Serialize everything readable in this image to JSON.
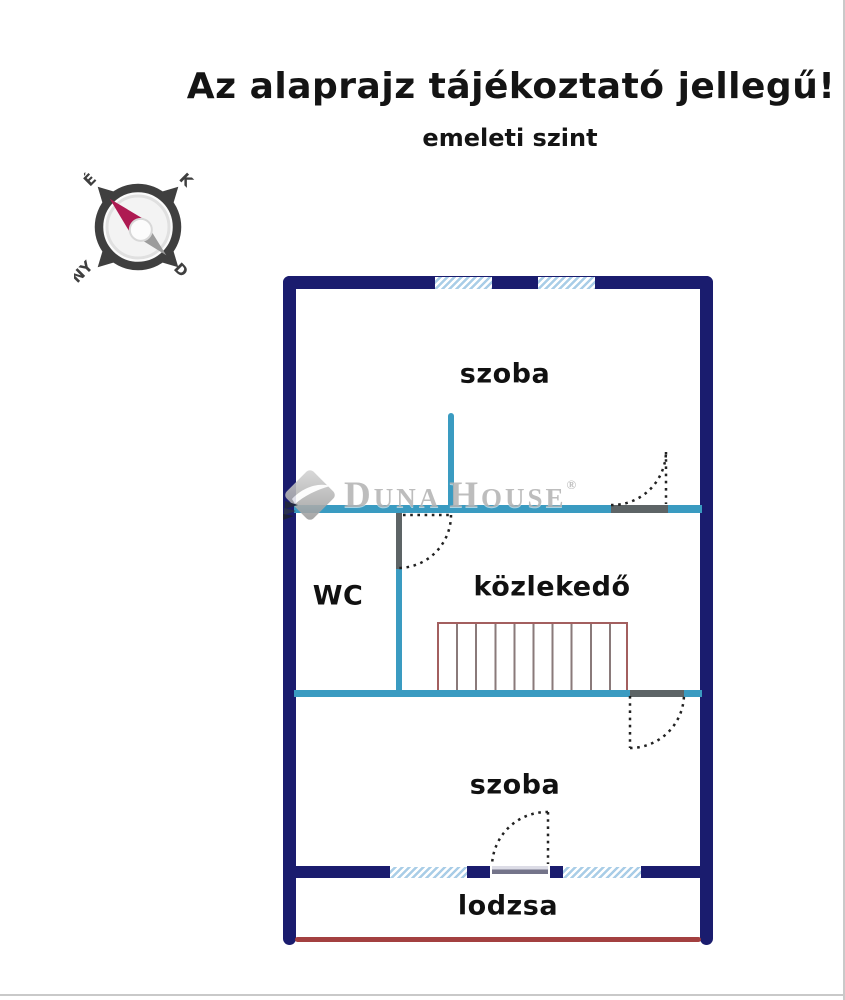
{
  "header": {
    "title": "Az alaprajz tájékoztató jellegű!",
    "subtitle": "emeleti szint"
  },
  "compass": {
    "north": "É",
    "east": "K",
    "south": "D",
    "west": "NY"
  },
  "rooms": {
    "room_top": "szoba",
    "wc": "WC",
    "hallway": "közlekedő",
    "room_bottom": "szoba",
    "loggia": "lodzsa"
  },
  "watermark": {
    "word1_initial": "D",
    "word1_rest": "UNA",
    "word2_initial": "H",
    "word2_rest": "OUSE",
    "registered": "®"
  },
  "colors": {
    "wall_navy": "#1a1c6e",
    "partition_teal": "#3a9bc1",
    "opening_gray": "#5d6466",
    "window_blue": "#a9cde7",
    "stairs_outline_red": "#a35f5f",
    "stair_tread_gray": "#8a7a7a",
    "loggia_edge_red": "#a34040",
    "compass_needle_north": "#ae1a52",
    "compass_needle_south": "#9c9c9c",
    "label_text": "#111111",
    "watermark_gray": "#b5b5b5"
  }
}
